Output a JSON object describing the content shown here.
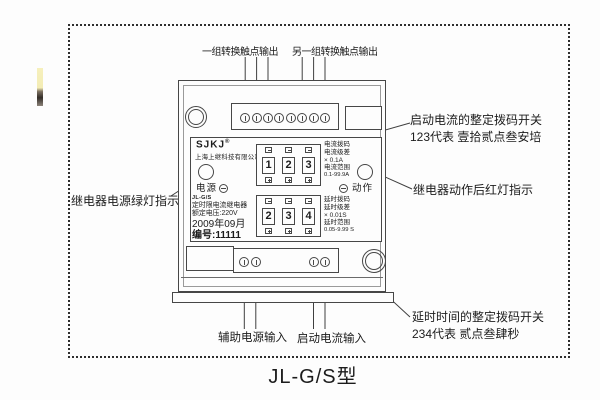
{
  "title": "JL-G/S型",
  "callouts": {
    "top_left": "一组转换触点输出",
    "top_right": "另一组转换触点输出",
    "right_current_line1": "启动电流的整定拨码开关",
    "right_current_line2": "123代表 壹拾贰点叁安培",
    "right_action": "继电器动作后红灯指示",
    "left_power": "继电器电源绿灯指示",
    "delay_line1": "延时时间的整定拨码开关",
    "delay_line2": "234代表 贰点叁肆秒",
    "aux_input": "辅助电源输入",
    "start_input": "启动电流输入"
  },
  "device": {
    "brand": "SJKJ",
    "brand_reg": "®",
    "company": "上海上继科技有限公司",
    "power_label": "电源",
    "action_label": "动作",
    "model_small": "JL-G/S",
    "product_name": "定时限电流继电器",
    "rated_voltage": "额定电压:220V",
    "date": "2009年09月",
    "serial": "编号:11111",
    "current_dip": {
      "digits": [
        "1",
        "2",
        "3"
      ],
      "info_lines": [
        "电流拨码",
        "电流级差",
        "× 0.1A",
        "电流范围",
        "0.1-99.9A"
      ]
    },
    "delay_dip": {
      "digits": [
        "2",
        "3",
        "4"
      ],
      "info_lines": [
        "延时拨码",
        "延时级差",
        "× 0.01S",
        "延时范围",
        "0.05-9.99 S"
      ]
    }
  },
  "icons": {
    "panel_screw": "slotted-circle",
    "terminal": "slotted-circle",
    "screw_slot": "circled-minus",
    "dip_decrement": "minus",
    "dip_increment": "plus"
  },
  "colors": {
    "ink": "#3f3f3f",
    "text": "#1c1c1c",
    "paper": "#fdfdfd",
    "artifact_yellow": "#f3ecb4"
  }
}
